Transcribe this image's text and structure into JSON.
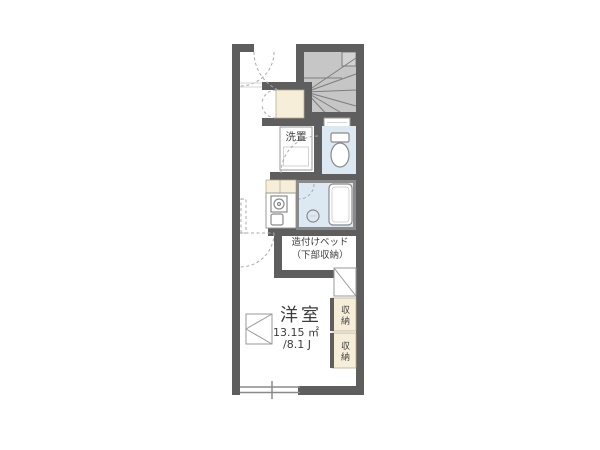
{
  "floorplan": {
    "type": "japanese-apartment-floor-plan",
    "labels": {
      "laundry": "洗置",
      "built_in_bed_line1": "造付けベッド",
      "built_in_bed_line2": "（下部収納）",
      "room_name": "洋室",
      "room_area_sqm": "13.15 ㎡",
      "room_area_tatami": "/8.1 J",
      "storage_upper": "収納",
      "storage_lower": "収納"
    },
    "colors": {
      "background": "#ffffff",
      "wall": "#5e5e5e",
      "stairs_fill": "#c6c6c6",
      "stairs_line": "#7d7d7d",
      "cream": "#f6eed8",
      "cream_border": "#b3a98e",
      "wet_area": "#dce8f2",
      "fixture_line": "#8a8a8a",
      "outline": "#999999",
      "dash": "#aaaaaa",
      "text": "#3d3d3d"
    },
    "icons": [
      "staircase-icon",
      "toilet-icon",
      "bathtub-icon",
      "shower-drain-icon",
      "stove-icon",
      "kitchen-sink-icon",
      "washing-machine-pan-icon",
      "door-swing-arc-icon",
      "folding-closet-door-icon",
      "window-icon",
      "fold-down-table-icon",
      "diagonal-shelf-icon"
    ]
  }
}
